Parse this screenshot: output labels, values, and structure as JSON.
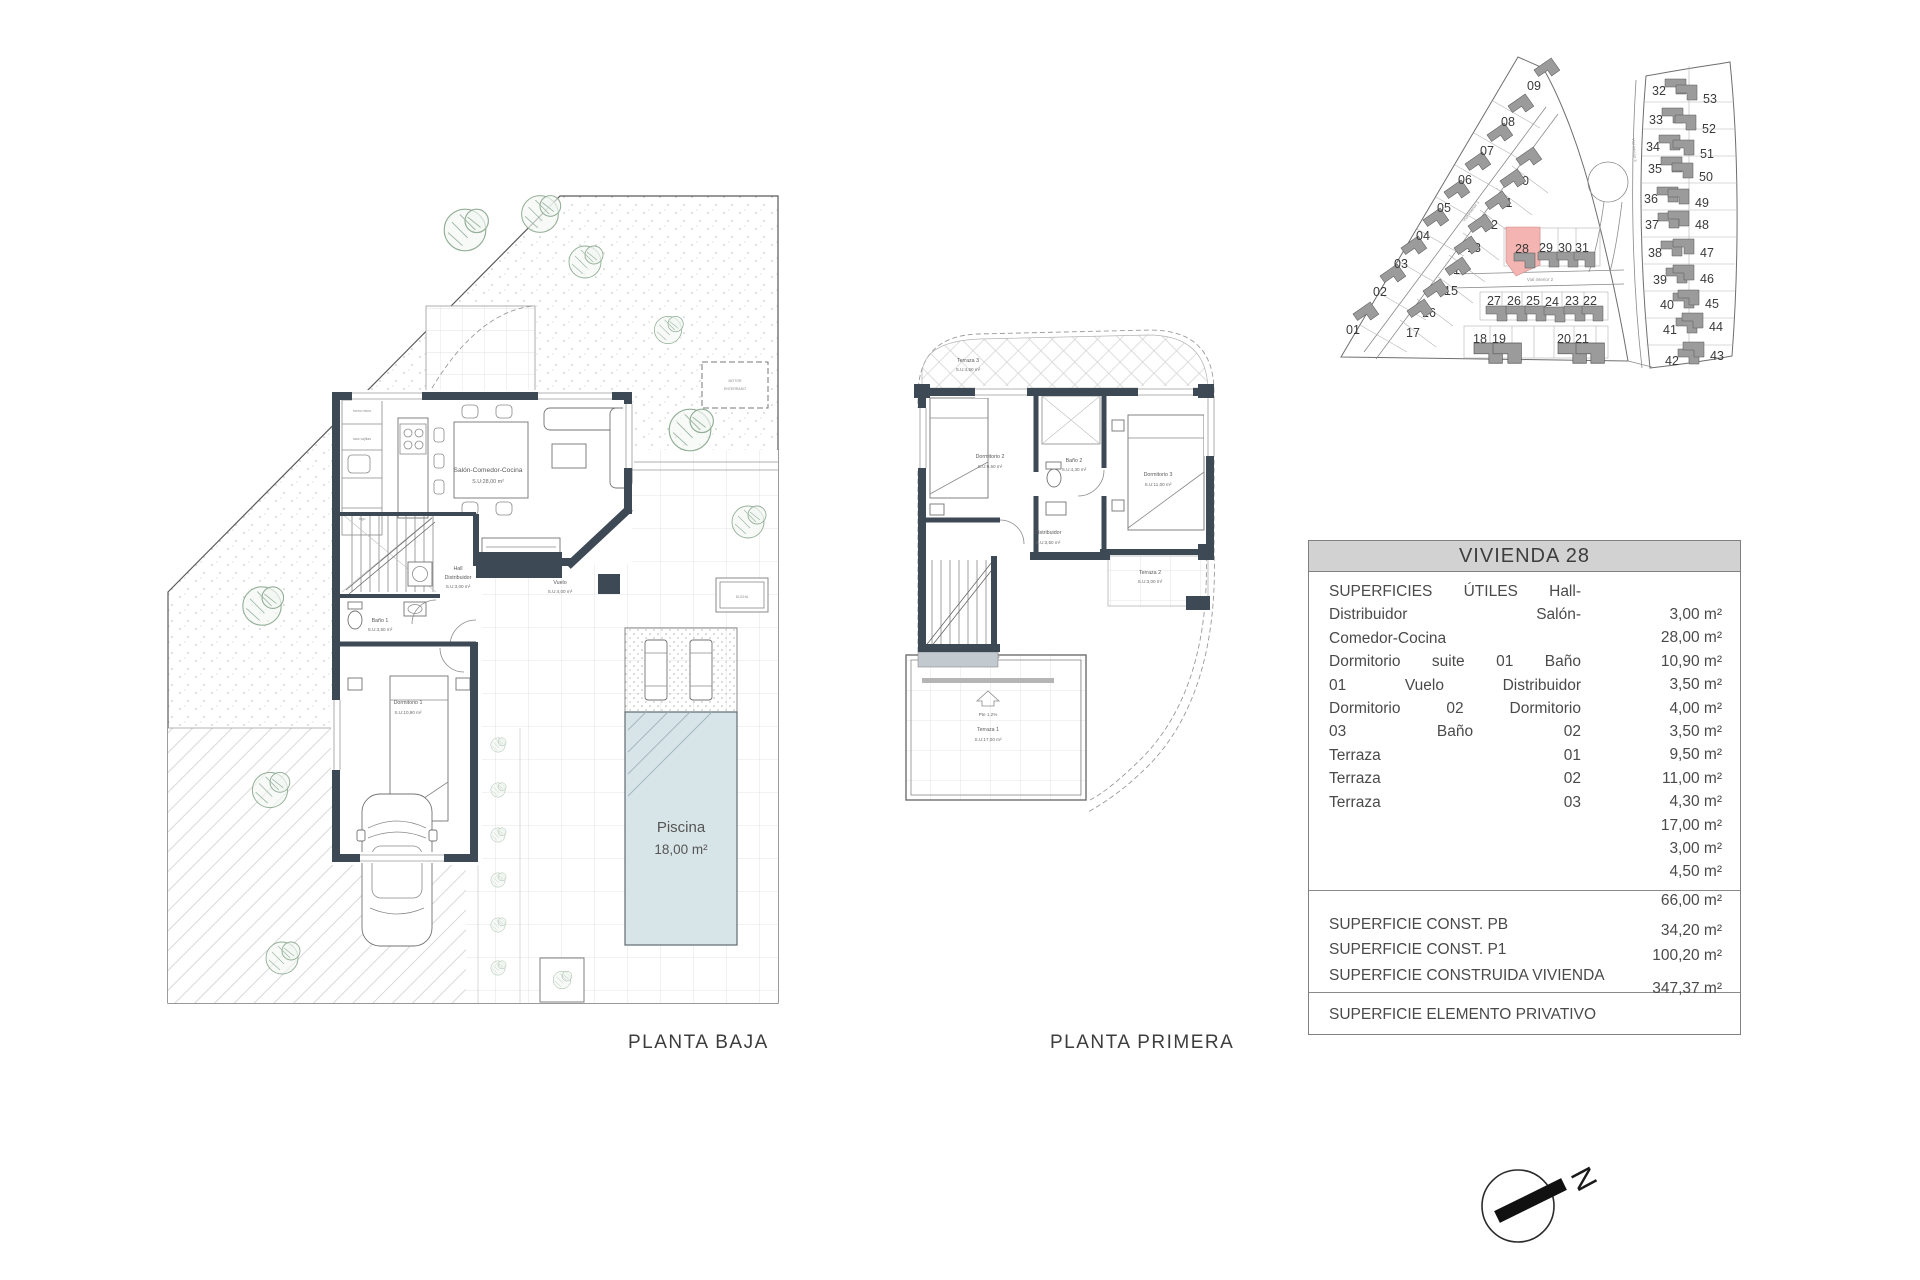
{
  "page": {
    "captions": {
      "planta_baja": "PLANTA BAJA",
      "planta_primera": "PLANTA PRIMERA"
    }
  },
  "colors": {
    "wall": "#3e4956",
    "pool": "#d8e5e8",
    "plot_highlight": "#f4b4b1",
    "table_header_bg": "#d2d2d2"
  },
  "planta_baja": {
    "rooms": {
      "salon": {
        "name": "Salón-Comedor-Cocina",
        "area": "S.U:28,00 m²"
      },
      "hall": {
        "name": "Hall",
        "name2": "Distribuidor",
        "area": "S.U:3,00 m²"
      },
      "bano1": {
        "name": "Baño 1",
        "area": "S.U:3,50 m²"
      },
      "dormitorio1": {
        "name": "Dormitorio 1",
        "area": "S.U:10,90 m²"
      },
      "vuelo": {
        "name": "Vuelo",
        "area": "S.U:4,00 m²"
      },
      "piscina": {
        "name": "Piscina",
        "area": "18,00 m²"
      }
    },
    "annotations": {
      "motor1": "MOTOR",
      "motor2": "ENTERRADO",
      "ducha": "DUCHA",
      "kitchen1": "horno micro",
      "kitchen2": "lava vajillas",
      "kitchen3": "frigo"
    }
  },
  "planta_primera": {
    "rooms": {
      "terraza3": {
        "name": "Terraza 3",
        "area": "S.U:4,50 m²"
      },
      "dormitorio2": {
        "name": "Dormitorio 2",
        "area": "S.U:9,50 m²"
      },
      "bano2": {
        "name": "Baño 2",
        "area": "S.U:4,30 m²"
      },
      "dormitorio3": {
        "name": "Dormitorio 3",
        "area": "S.U:11,00 m²"
      },
      "distribuidor": {
        "name": "Distribuidor",
        "area": "S.U:3,50 m²"
      },
      "terraza2": {
        "name": "Terraza 2",
        "area": "S.U:3,00 m²"
      },
      "terraza1": {
        "name": "Terraza 1",
        "area": "S.U:17,00 m²"
      }
    },
    "slope_label": "Pte 1.2%"
  },
  "site_plan": {
    "highlighted_plot": "28",
    "roads": {
      "r1": "Vial Interior 1",
      "r2": "Vial interior 2",
      "r3": "Vial Interior 3"
    },
    "plots": [
      {
        "n": "01",
        "x": 1353,
        "y": 330,
        "g": 1
      },
      {
        "n": "02",
        "x": 1380,
        "y": 292,
        "g": 1
      },
      {
        "n": "03",
        "x": 1401,
        "y": 264,
        "g": 1
      },
      {
        "n": "04",
        "x": 1423,
        "y": 236,
        "g": 1
      },
      {
        "n": "05",
        "x": 1444,
        "y": 208,
        "g": 1
      },
      {
        "n": "06",
        "x": 1465,
        "y": 180,
        "g": 1
      },
      {
        "n": "07",
        "x": 1487,
        "y": 151,
        "g": 1
      },
      {
        "n": "08",
        "x": 1508,
        "y": 122,
        "g": 1
      },
      {
        "n": "09",
        "x": 1534,
        "y": 86,
        "g": 1
      },
      {
        "n": "10",
        "x": 1522,
        "y": 181,
        "g": 2
      },
      {
        "n": "11",
        "x": 1506,
        "y": 203,
        "g": 2
      },
      {
        "n": "12",
        "x": 1491,
        "y": 225,
        "g": 2
      },
      {
        "n": "13",
        "x": 1474,
        "y": 248,
        "g": 2
      },
      {
        "n": "14",
        "x": 1460,
        "y": 270,
        "g": 2
      },
      {
        "n": "15",
        "x": 1451,
        "y": 291,
        "g": 2
      },
      {
        "n": "16",
        "x": 1429,
        "y": 313,
        "g": 2
      },
      {
        "n": "17",
        "x": 1413,
        "y": 333,
        "g": 2
      },
      {
        "n": "28",
        "x": 1522,
        "y": 249,
        "g": 3,
        "hl": true
      },
      {
        "n": "29",
        "x": 1546,
        "y": 248,
        "g": 3
      },
      {
        "n": "30",
        "x": 1565,
        "y": 248,
        "g": 3
      },
      {
        "n": "31",
        "x": 1582,
        "y": 248,
        "g": 3
      },
      {
        "n": "27",
        "x": 1494,
        "y": 301,
        "g": 4
      },
      {
        "n": "26",
        "x": 1514,
        "y": 301,
        "g": 4
      },
      {
        "n": "25",
        "x": 1533,
        "y": 301,
        "g": 4
      },
      {
        "n": "24",
        "x": 1552,
        "y": 302,
        "g": 4
      },
      {
        "n": "23",
        "x": 1572,
        "y": 301,
        "g": 4
      },
      {
        "n": "22",
        "x": 1590,
        "y": 301,
        "g": 4
      },
      {
        "n": "18",
        "x": 1480,
        "y": 339,
        "g": 5
      },
      {
        "n": "19",
        "x": 1499,
        "y": 339,
        "g": 5
      },
      {
        "n": "20",
        "x": 1564,
        "y": 339,
        "g": 5
      },
      {
        "n": "21",
        "x": 1582,
        "y": 339,
        "g": 5
      },
      {
        "n": "32",
        "x": 1659,
        "y": 91,
        "g": 6
      },
      {
        "n": "33",
        "x": 1656,
        "y": 120,
        "g": 6
      },
      {
        "n": "34",
        "x": 1653,
        "y": 147,
        "g": 6
      },
      {
        "n": "35",
        "x": 1655,
        "y": 169,
        "g": 6
      },
      {
        "n": "36",
        "x": 1651,
        "y": 199,
        "g": 6
      },
      {
        "n": "37",
        "x": 1652,
        "y": 225,
        "g": 6
      },
      {
        "n": "38",
        "x": 1655,
        "y": 253,
        "g": 6
      },
      {
        "n": "39",
        "x": 1660,
        "y": 280,
        "g": 6
      },
      {
        "n": "40",
        "x": 1667,
        "y": 305,
        "g": 6
      },
      {
        "n": "41",
        "x": 1670,
        "y": 330,
        "g": 6
      },
      {
        "n": "42",
        "x": 1672,
        "y": 361,
        "g": 6
      },
      {
        "n": "53",
        "x": 1710,
        "y": 99,
        "g": 7
      },
      {
        "n": "52",
        "x": 1709,
        "y": 129,
        "g": 7
      },
      {
        "n": "51",
        "x": 1707,
        "y": 154,
        "g": 7
      },
      {
        "n": "50",
        "x": 1706,
        "y": 177,
        "g": 7
      },
      {
        "n": "49",
        "x": 1702,
        "y": 203,
        "g": 7
      },
      {
        "n": "48",
        "x": 1702,
        "y": 225,
        "g": 7
      },
      {
        "n": "47",
        "x": 1707,
        "y": 253,
        "g": 7
      },
      {
        "n": "46",
        "x": 1707,
        "y": 279,
        "g": 7
      },
      {
        "n": "45",
        "x": 1712,
        "y": 304,
        "g": 7
      },
      {
        "n": "44",
        "x": 1716,
        "y": 327,
        "g": 7
      },
      {
        "n": "43",
        "x": 1717,
        "y": 356,
        "g": 7
      }
    ]
  },
  "table": {
    "title": "VIVIENDA 28",
    "left_lines": [
      "SUPERFICIES ÚTILES Hall-",
      "Distribuidor Salón-",
      "Comedor-Cocina",
      "Dormitorio suite 01 Baño",
      "01 Vuelo Distribuidor",
      "Dormitorio 02 Dormitorio",
      "03 Baño 02",
      "Terraza 01",
      "Terraza 02",
      "Terraza 03"
    ],
    "values": [
      "3,00 m²",
      "28,00 m²",
      "10,90 m²",
      "3,50 m²",
      "4,00 m²",
      "3,50 m²",
      "9,50 m²",
      "11,00 m²",
      "4,30 m²",
      "17,00 m²",
      "3,00 m²",
      "4,50 m²"
    ],
    "subtotal": "66,00 m²",
    "const_rows": [
      {
        "label": "SUPERFICIE CONST. PB",
        "value": "34,20 m²"
      },
      {
        "label": "SUPERFICIE CONST. P1",
        "value": "100,20 m²"
      },
      {
        "label": "SUPERFICIE CONSTRUIDA VIVIENDA",
        "value": ""
      }
    ],
    "total": "347,37 m²",
    "privative_label": "SUPERFICIE ELEMENTO PRIVATIVO"
  },
  "compass": {
    "north_letter": "N"
  }
}
